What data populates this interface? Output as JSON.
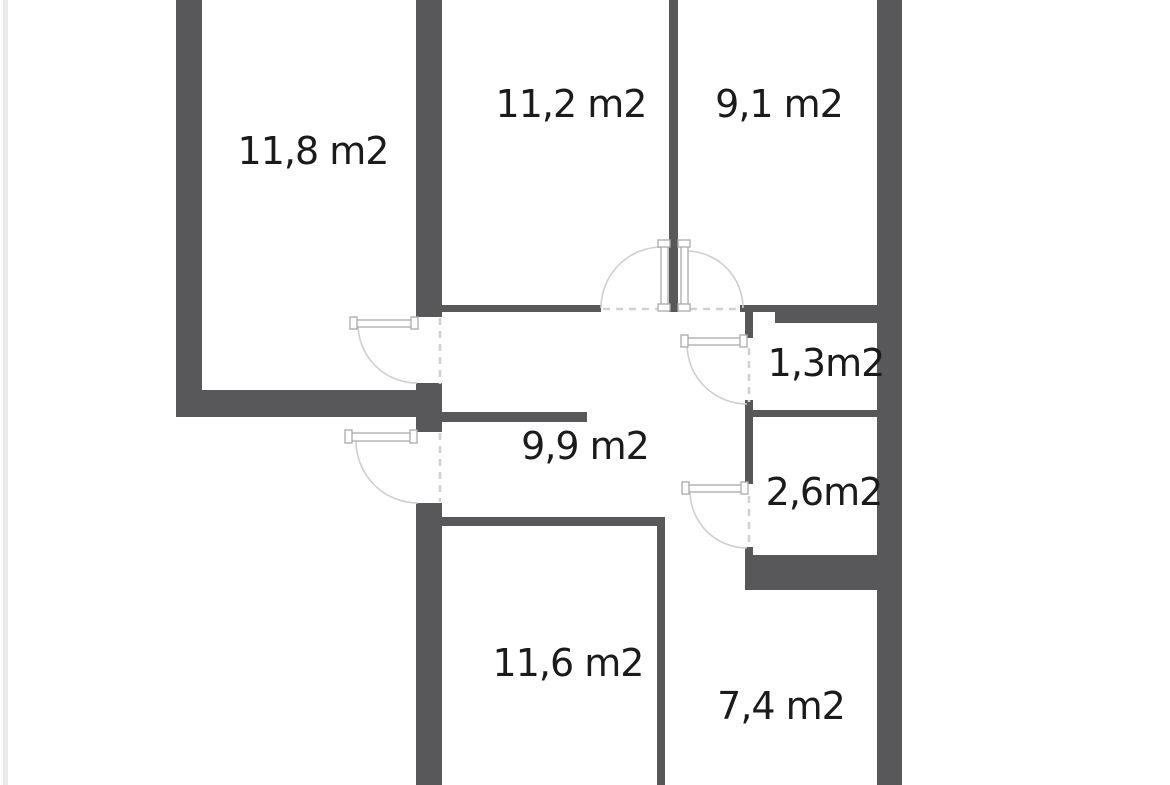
{
  "meta": {
    "view": "apartment-floor-plan",
    "area_unit": "m2"
  },
  "palette": {
    "background": "#ffffff",
    "edge_strip": "#e9e9e9",
    "wall": "#58585A",
    "label_text": "#1b1b1b",
    "door_line": "#cfcfcf",
    "opening_dash": "#d2d2d2",
    "panel_fill": "#ffffff",
    "panel_stroke": "#ababab"
  },
  "rooms": [
    {
      "name": "top-left",
      "label": "11,8 m2",
      "area": "11,8",
      "label_x": 313,
      "label_y": 151
    },
    {
      "name": "top-middle",
      "label": "11,2 m2",
      "area": "11,2",
      "label_x": 571,
      "label_y": 104
    },
    {
      "name": "top-right",
      "label": "9,1 m2",
      "area": "9,1",
      "label_x": 779,
      "label_y": 104
    },
    {
      "name": "closet",
      "label": "1,3m2",
      "area": "1,3",
      "label_x": 826,
      "label_y": 363
    },
    {
      "name": "hallway",
      "label": "9,9 m2",
      "area": "9,9",
      "label_x": 585,
      "label_y": 446
    },
    {
      "name": "wc",
      "label": "2,6m2",
      "area": "2,6",
      "label_x": 824,
      "label_y": 492
    },
    {
      "name": "bottom-middle",
      "label": "11,6 m2",
      "area": "11,6",
      "label_x": 568,
      "label_y": 663
    },
    {
      "name": "bottom-right",
      "label": "7,4 m2",
      "area": "7,4",
      "label_x": 781,
      "label_y": 706
    }
  ]
}
